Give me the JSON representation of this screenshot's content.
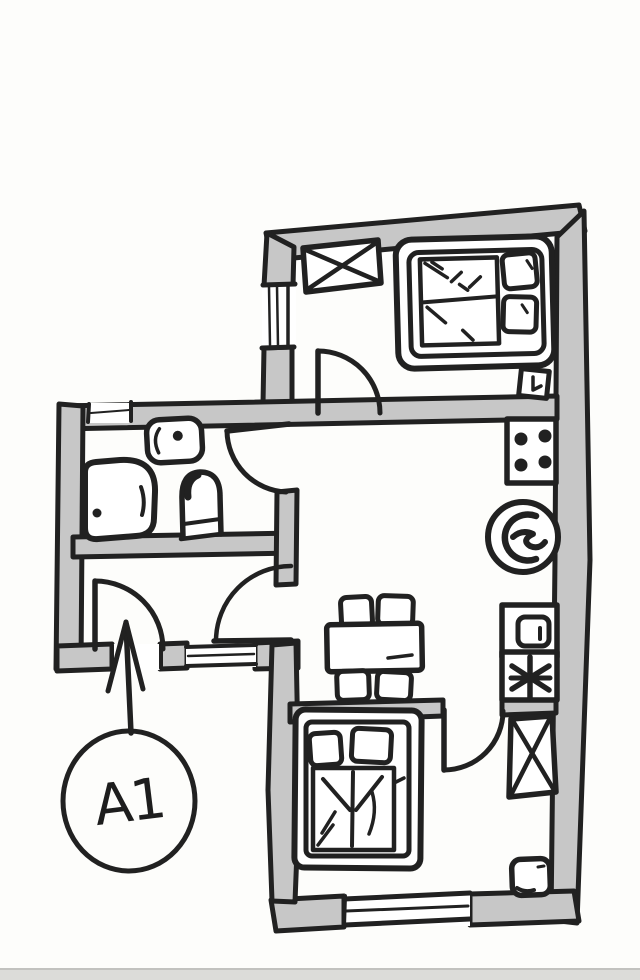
{
  "image": {
    "title": "Hand-drawn apartment floor plan sketch",
    "style": "black marker on white paper, gray filled walls"
  },
  "annotation": {
    "label": "A1",
    "shape": "circle with long arrow",
    "points_to": "entrance-door in hallway bottom wall"
  },
  "colors": {
    "paper": "#fdfdfb",
    "wall_fill": "#c7c7c7",
    "ink": "#212121",
    "scan_edge_band": "#d6d6d3"
  },
  "rooms": [
    {
      "name": "bedroom-top",
      "position": "top of main block",
      "furniture": [
        "wardrobe (rectangle with X)",
        "double bed with two pillows"
      ],
      "features": [
        "window in left wall",
        "door to living room (swing into bedroom)",
        "small wall panel on right wall"
      ]
    },
    {
      "name": "kitchen-living-room",
      "position": "middle of main block",
      "furniture": [
        "stove with 4 burners",
        "round kitchen sink",
        "oven/dishwasher",
        "freezer (asterisk symbol)",
        "dining table",
        "four chairs"
      ],
      "features": [
        "fixtures aligned on right wall"
      ]
    },
    {
      "name": "bathroom",
      "position": "left annex, upper half",
      "furniture": [
        "washbasin with tap dot",
        "bathtub",
        "toilet"
      ],
      "features": [
        "small window in top wall",
        "door from living room side"
      ]
    },
    {
      "name": "hallway",
      "position": "left annex, lower half",
      "furniture": [],
      "features": [
        "entrance door gap in bottom wall",
        "window in bottom wall",
        "door to living room"
      ]
    },
    {
      "name": "bedroom-bottom",
      "position": "bottom of main block",
      "furniture": [
        "double bed with two pillows and folded blanket",
        "wardrobe (rectangle with X)",
        "nightstand"
      ],
      "features": [
        "window in bottom wall",
        "door from living room (swing into bedroom)"
      ]
    }
  ]
}
